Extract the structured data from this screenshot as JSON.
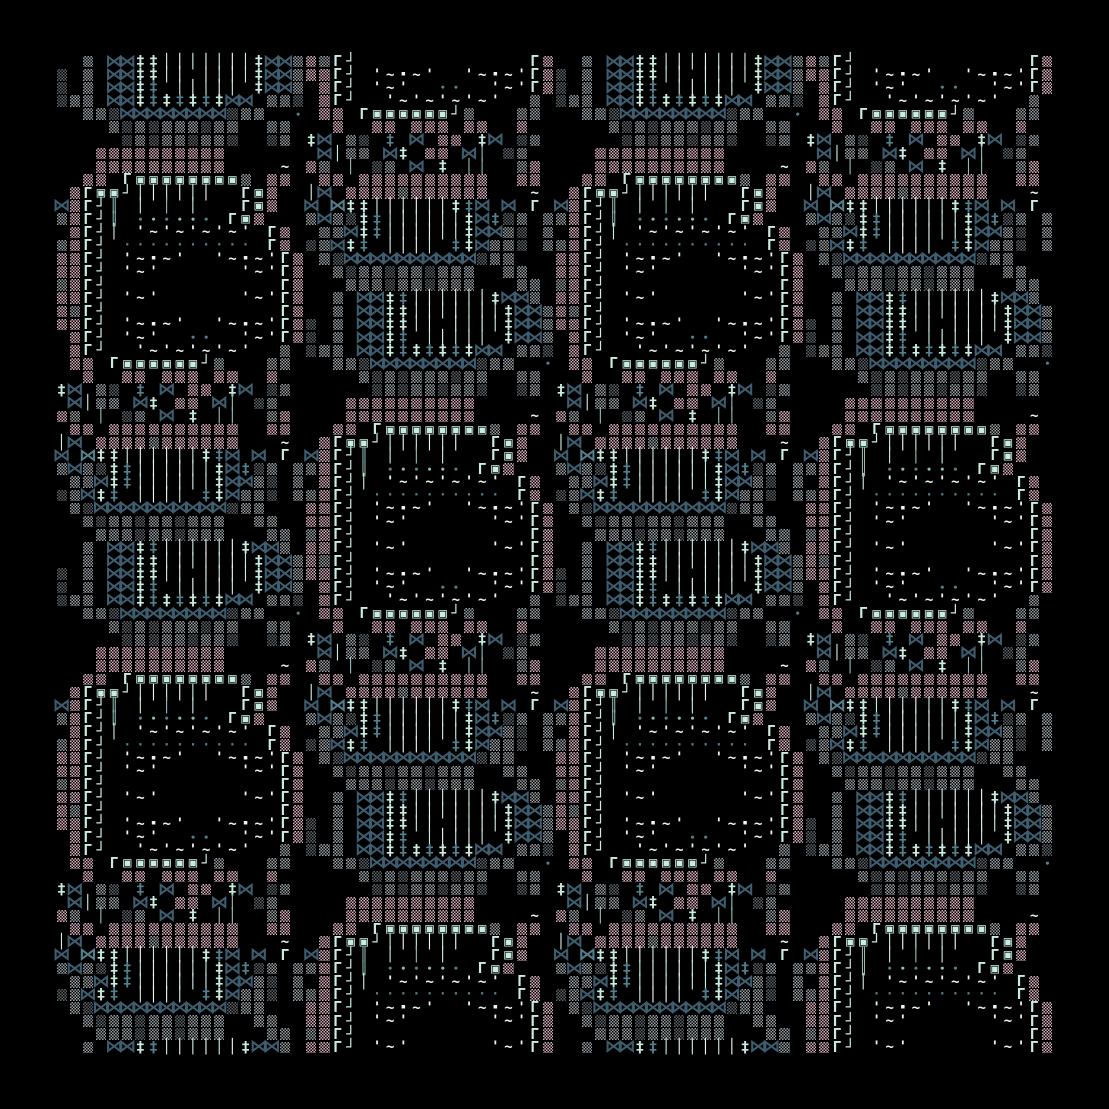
{
  "artwork": {
    "kind": "generative-ascii-pattern",
    "background": "#000000",
    "canvas": {
      "size_px": 1109,
      "margin_px": 55,
      "grid_cols": 76,
      "grid_rows": 76
    },
    "tiling": {
      "tile_cols": 38,
      "tile_rows": 38,
      "repeat_x": 2,
      "repeat_y": 2,
      "second_frame_row_offset": 19,
      "frame_cols": 19
    }
  },
  "palette": {
    "p": "#d9abbd",
    "g": "#99a0a4",
    "d": "#5d646a",
    "s": "#3e5e70",
    "t": "#54808e",
    "m": "#c8ece2",
    "w": "#eef4f2",
    "c": "#8fbdb6"
  },
  "glyphs": {
    "#": {
      "name": "dither-block",
      "cls": "b",
      "char": ""
    },
    "X": {
      "name": "bowtie",
      "cls": "x",
      "char": "⋈"
    },
    "=": {
      "name": "cross-dagger",
      "cls": "q",
      "char": "‡"
    },
    "|": {
      "name": "vertical-bar",
      "cls": "v",
      "char": "│"
    },
    "!": {
      "name": "double-bar",
      "cls": "u",
      "char": "║"
    },
    "G": {
      "name": "corner-gamma",
      "cls": "gm",
      "char": "Γ"
    },
    "J": {
      "name": "corner-hook",
      "cls": "j",
      "char": "┘"
    },
    "O": {
      "name": "square-spiral",
      "cls": "o",
      "char": "▣"
    },
    "~": {
      "name": "tilde-wave",
      "cls": "tl",
      "char": "~"
    },
    "'": {
      "name": "tick",
      "cls": "ap",
      "char": "'"
    },
    ".": {
      "name": "dot",
      "cls": "dt",
      "char": "∙"
    },
    ",": {
      "name": "middot",
      "cls": "d2",
      "char": "·"
    },
    "s": {
      "name": "small-square",
      "cls": "sq",
      "char": "▪"
    }
  },
  "frame": {
    "rows": [
      "  # XX==|||||||=XX#",
      "# # XX==|| ||||=XX#",
      "# # XX== ||||| =XX#",
      "### XX=======XX ###",
      "  ###XXXXXXXX###  .",
      "    ##########  ## ",
      "     #########  ## ",
      "   ##########      ",
      "   ##########    ~ ",
      "  ## GOOOOOOOO# ## ",
      " #GOOJ||||||  GO#  ",
      "X#GJ! | | |   GO#  ",
      "##GJ! ...... GO#   ",
      " #GJ| '~'~'~'~' G# ",
      "##GJ ,,,,,,,,,, G# ",
      "##GJ '~s~'  '~s~'G#",
      "##GJ '~'      '~'G#",
      "##GJ             G#",
      "##GJ '~'      '~'G#",
      "##GJ             G#",
      "##GJ '~s~'  '~s~'G#",
      " #GJ '~'  ..  '~'G#",
      " #GJ  '~'~'~'~'  # ",
      " ## GOOOOOOJ#   ## ",
      "  #  ## ### ##  #  ",
      "=X ## = X ## =X ## ",
      " X|## X= ## X| ##  ",
      "## | ## X = ||  ## ",
      " ## ##########  ## ",
      "|X ###########   ~ ",
      "X X==||||||==X X G ",
      "#X##==||||||=X=## #",
      " ##X==||||||=XX## #",
      "##X== |||| ==X### #",
      " ##XXXXXXXXXX###   ",
      "  ###########  ##  ",
      "   ##########   ## ",
      "  # XX==||||||=XX# "
    ],
    "colors": [
      "..g.ssmmmwmwmwmmssg",
      "d.g.ssmmmw.wmwmmssg",
      "d.g.ssmt.mwmwm.mssg",
      "dgg.ssmtmtmtmss.ggd",
      "..ggdssssssssdgg..t",
      "....gdgdgggdgg..gg.",
      ".....dgdggdggd..dg.",
      "...pppppppppp......",
      "...pppppppppp....w.",
      "..pp.mmmmmmmmmg.pp.",
      ".pmmmmmwmwmw..mmp..",
      "spmmc.m.c.m...mmp..",
      "gpmmc.tctcct.mmp...",
      ".pmmm.wwwwwwwww.mp.",
      "gpmm.tttttttttt.mp.",
      "ppmm.wwwww..wwwwwmp",
      "ppmm.www......wwwmp",
      "gpmm.............mp",
      "ppmm.www......wwwmp",
      "pgmm.............mp",
      "ppmm.wwwww..wwwwwmp",
      ".pmm.www..tt..wwwmp",
      ".pmm..wwwwwwwww..g.",
      ".pp.mmmmmmmmg...gg.",
      "..p..pp.ppp.pp..p..",
      "ms.gd.t.s.pp.ms.dg.",
      ".smgg.sm.pp.sc.dg..",
      "pg.c.dg.s.m.cc..gp.",
      ".pp.pppppppppp..pp.",
      "ms.ppppgpppppp...w.",
      "s.tmmmwmwmmmts.s.m.",
      "gsgdmtmwmwmmmstdg.g",
      ".ggsmtmwmwmmmssgd.g",
      "dgsmt.mwwm.tmsggd.g",
      ".gdssssssssssdgg...",
      "..gdggdggdggg..gg..",
      "...gggdggdggg...gg.",
      "..g.ssmtmwmwmwmssg."
    ]
  }
}
